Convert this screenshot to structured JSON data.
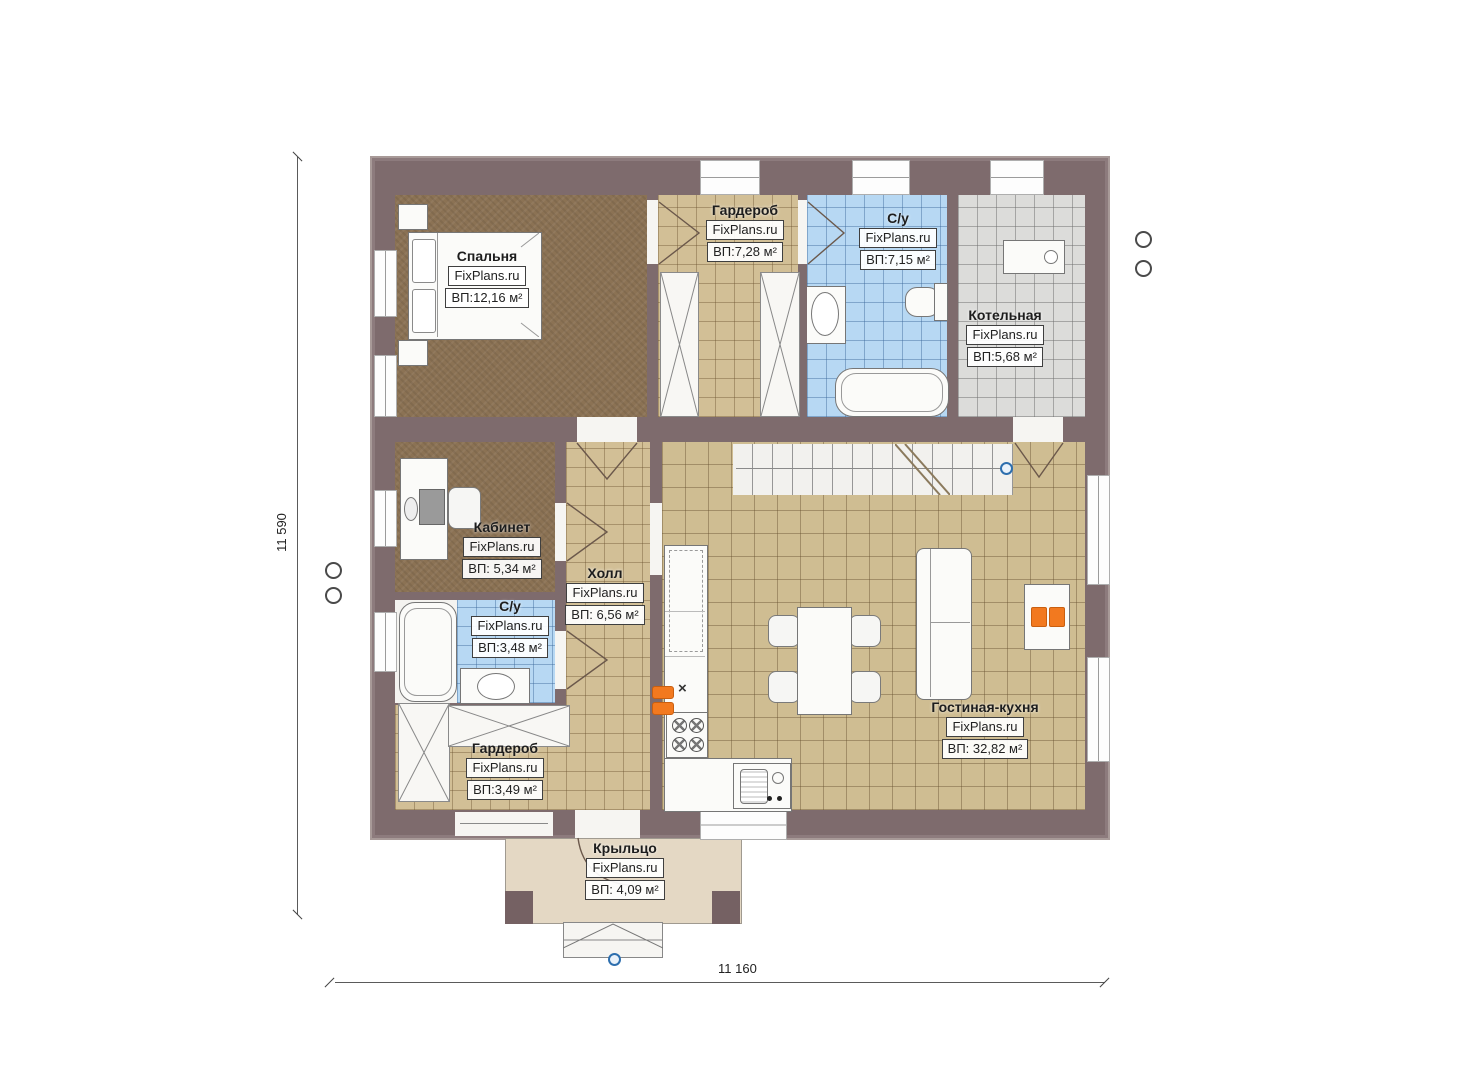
{
  "brand": "FixPlans.ru",
  "dimensions": {
    "vertical": "11 590",
    "horizontal": "11 160"
  },
  "rooms": [
    {
      "id": "bedroom",
      "name": "Спальня",
      "area": "ВП:12,16 м²"
    },
    {
      "id": "wardrobe-top",
      "name": "Гардероб",
      "area": "ВП:7,28 м²"
    },
    {
      "id": "bathroom-top",
      "name": "С/у",
      "area": "ВП:7,15 м²"
    },
    {
      "id": "boiler-room",
      "name": "Котельная",
      "area": "ВП:5,68 м²"
    },
    {
      "id": "office",
      "name": "Кабинет",
      "area": "ВП: 5,34 м²"
    },
    {
      "id": "hall",
      "name": "Холл",
      "area": "ВП: 6,56 м²"
    },
    {
      "id": "bathroom-small",
      "name": "С/у",
      "area": "ВП:3,48 м²"
    },
    {
      "id": "wardrobe-bottom",
      "name": "Гардероб",
      "area": "ВП:3,49 м²"
    },
    {
      "id": "living-kitchen",
      "name": "Гостиная-кухня",
      "area": "ВП: 32,82 м²"
    },
    {
      "id": "porch",
      "name": "Крыльцо",
      "area": "ВП: 4,09 м²"
    }
  ],
  "symbols": {
    "kitchen_cross": "×"
  },
  "colors": {
    "wall": "#7e6b6d",
    "accent_orange": "#f2791f",
    "tile_blue": "#b7d8f3",
    "tile_beige": "#d2bf96",
    "tile_gray": "#dcdcda",
    "carpet": "#8b7254",
    "porch": "#e4d8c4"
  }
}
